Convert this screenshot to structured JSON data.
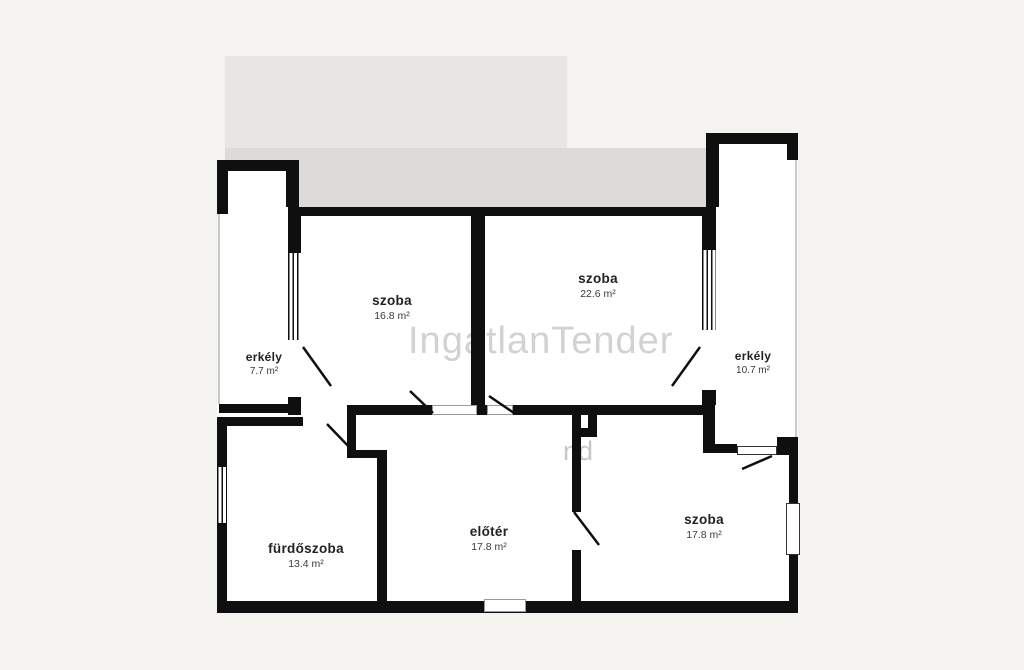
{
  "watermark": {
    "text": "IngatlanTender",
    "fragment": "nd"
  },
  "rooms": [
    {
      "name": "szoba",
      "area": "16.8 m²"
    },
    {
      "name": "szoba",
      "area": "22.6 m²"
    },
    {
      "name": "erkély",
      "area": "7.7 m²"
    },
    {
      "name": "erkély",
      "area": "10.7 m²"
    },
    {
      "name": "fürdőszoba",
      "area": "13.4 m²"
    },
    {
      "name": "előtér",
      "area": "17.8 m²"
    },
    {
      "name": "szoba",
      "area": "17.8 m²"
    }
  ],
  "colors": {
    "wall": "#0f0f0f",
    "background": "#f4f3f0",
    "floor": "#ffffff",
    "upper_gray_block": "#e7e6e3",
    "lower_gray_band": "#dcdbd8",
    "watermark": "#d2d2d4"
  }
}
